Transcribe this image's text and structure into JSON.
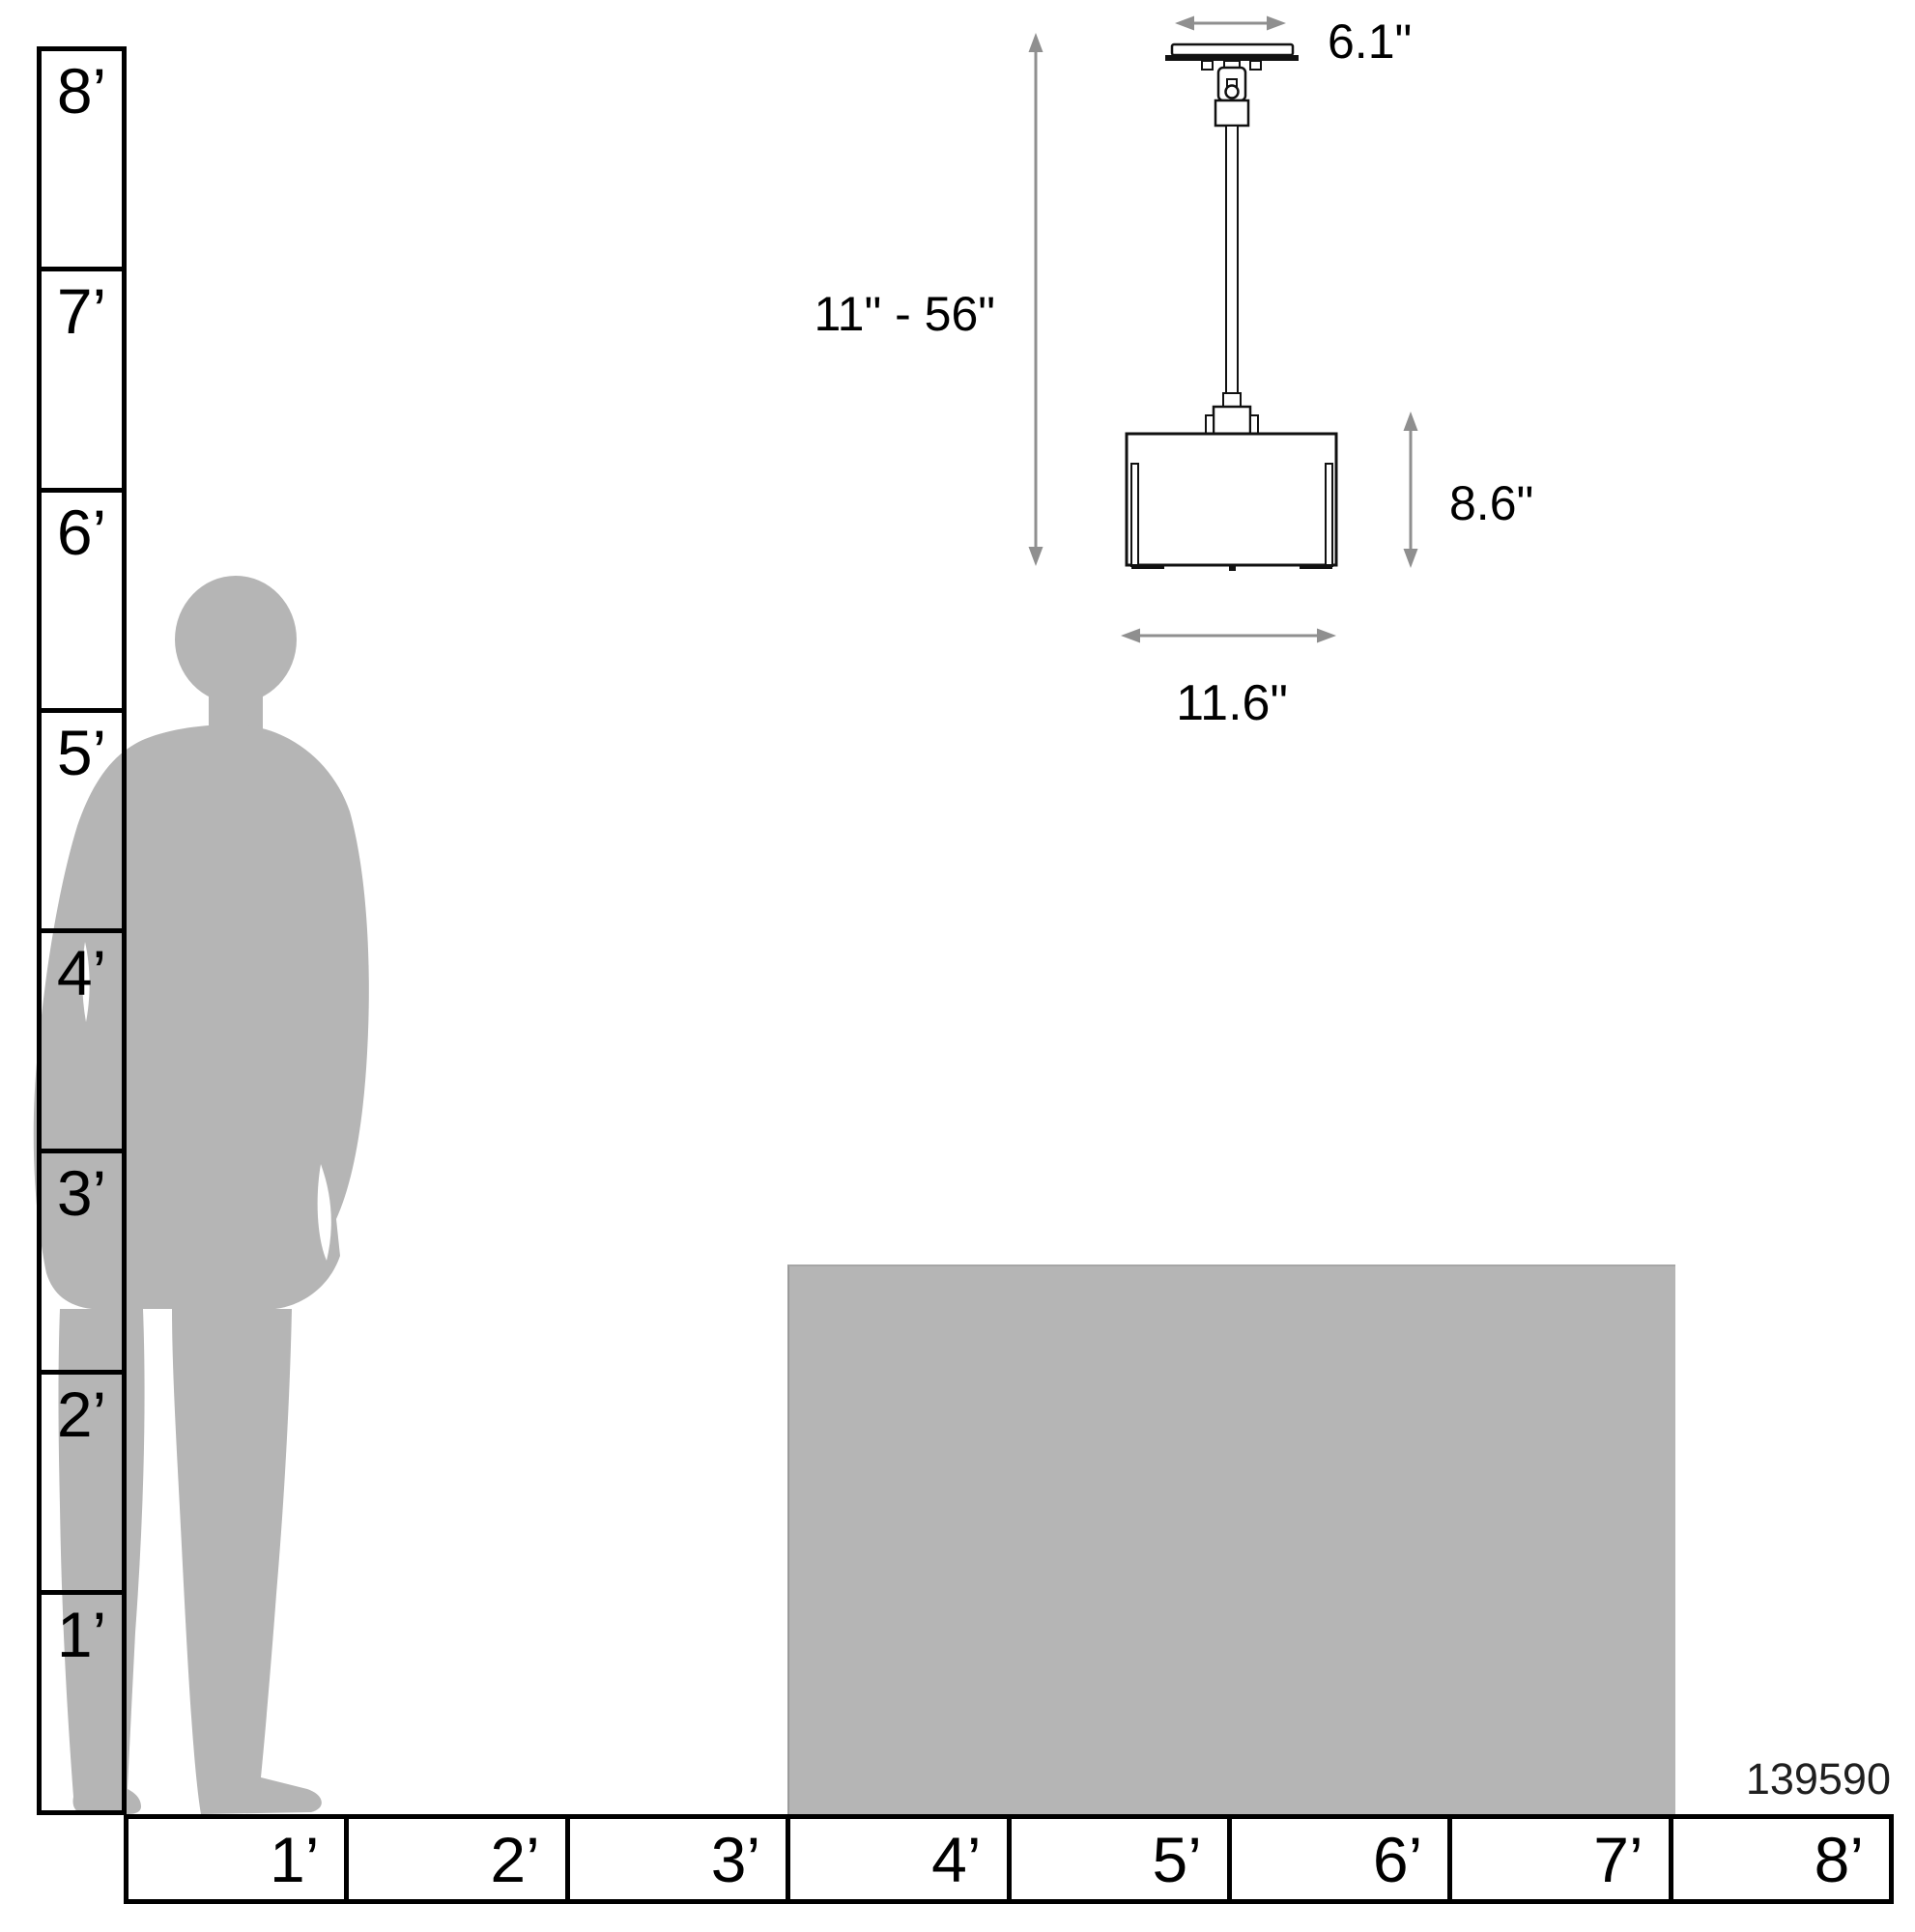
{
  "product_code": "139590",
  "dimensions": {
    "canopy_width": "6.1\"",
    "height_range": "11\" - 56\"",
    "shade_height": "8.6\"",
    "shade_width": "11.6\""
  },
  "rulers": {
    "vertical": {
      "unit": "feet",
      "labels": [
        "8’",
        "7’",
        "6’",
        "5’",
        "4’",
        "3’",
        "2’",
        "1’"
      ]
    },
    "horizontal": {
      "unit": "feet",
      "labels": [
        "1’",
        "2’",
        "3’",
        "4’",
        "5’",
        "6’",
        "7’",
        "8’"
      ]
    }
  },
  "colors": {
    "silhouette_gray": "#b5b5b5",
    "dimension_gray": "#8f8f8f",
    "line_black": "#000000"
  }
}
